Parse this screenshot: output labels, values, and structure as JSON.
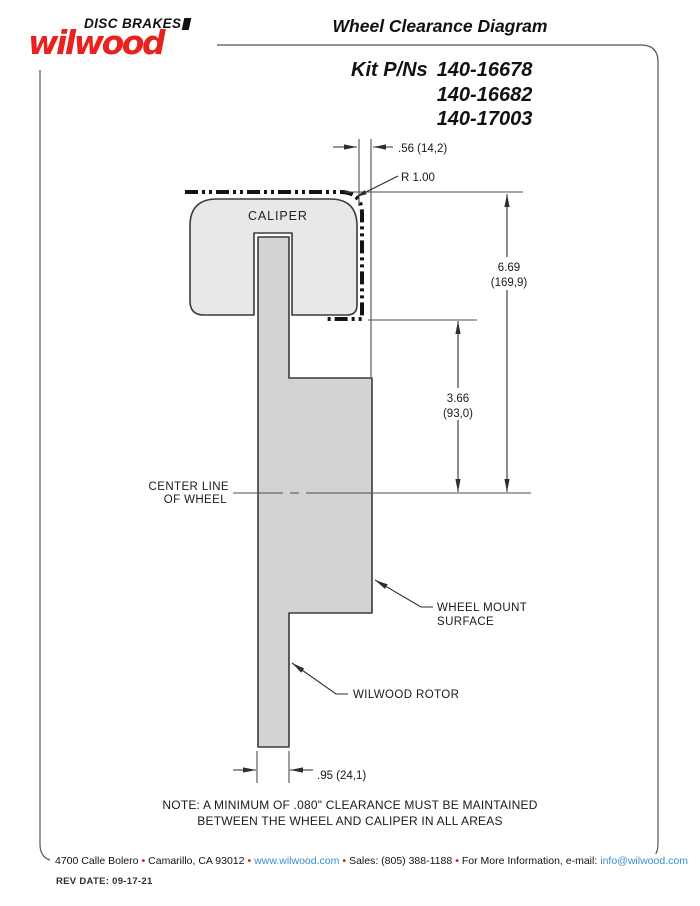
{
  "logo": {
    "tagline": "DISC BRAKES",
    "brand": "wilwood"
  },
  "title": "Wheel Clearance Diagram",
  "kit": {
    "label": "Kit P/Ns",
    "numbers": [
      "140-16678",
      "140-16682",
      "140-17003"
    ]
  },
  "diagram": {
    "caliper_label": "CALIPER",
    "offset_dim": ".56 (14,2)",
    "radius_dim": "R 1.00",
    "height_dim": {
      "in": "6.69",
      "mm": "(169,9)"
    },
    "mid_dim": {
      "in": "3.66",
      "mm": "(93,0)"
    },
    "centerline_label": {
      "line1": "CENTER LINE",
      "line2": "OF WHEEL"
    },
    "wheel_mount_label": {
      "line1": "WHEEL MOUNT",
      "line2": "SURFACE"
    },
    "rotor_label": "WILWOOD ROTOR",
    "rotor_width_dim": ".95 (24,1)"
  },
  "note": {
    "line1": "NOTE: A MINIMUM OF .080\" CLEARANCE MUST BE MAINTAINED",
    "line2": "BETWEEN THE WHEEL AND CALIPER IN ALL AREAS"
  },
  "footer": {
    "bullet": "•",
    "address": "4700 Calle Bolero",
    "city": "Camarillo, CA 93012",
    "website": "www.wilwood.com",
    "sales": "Sales: (805) 388-1188",
    "email_prefix": "For More Information, e-mail:",
    "email": "info@wilwood.com"
  },
  "rev_date": "REV DATE:  09-17-21",
  "colors": {
    "brand_red": "#e8231f",
    "link_blue": "#3a8fd0",
    "caliper_fill": "#e8e8e8",
    "rotor_fill": "#d3d3d3"
  }
}
